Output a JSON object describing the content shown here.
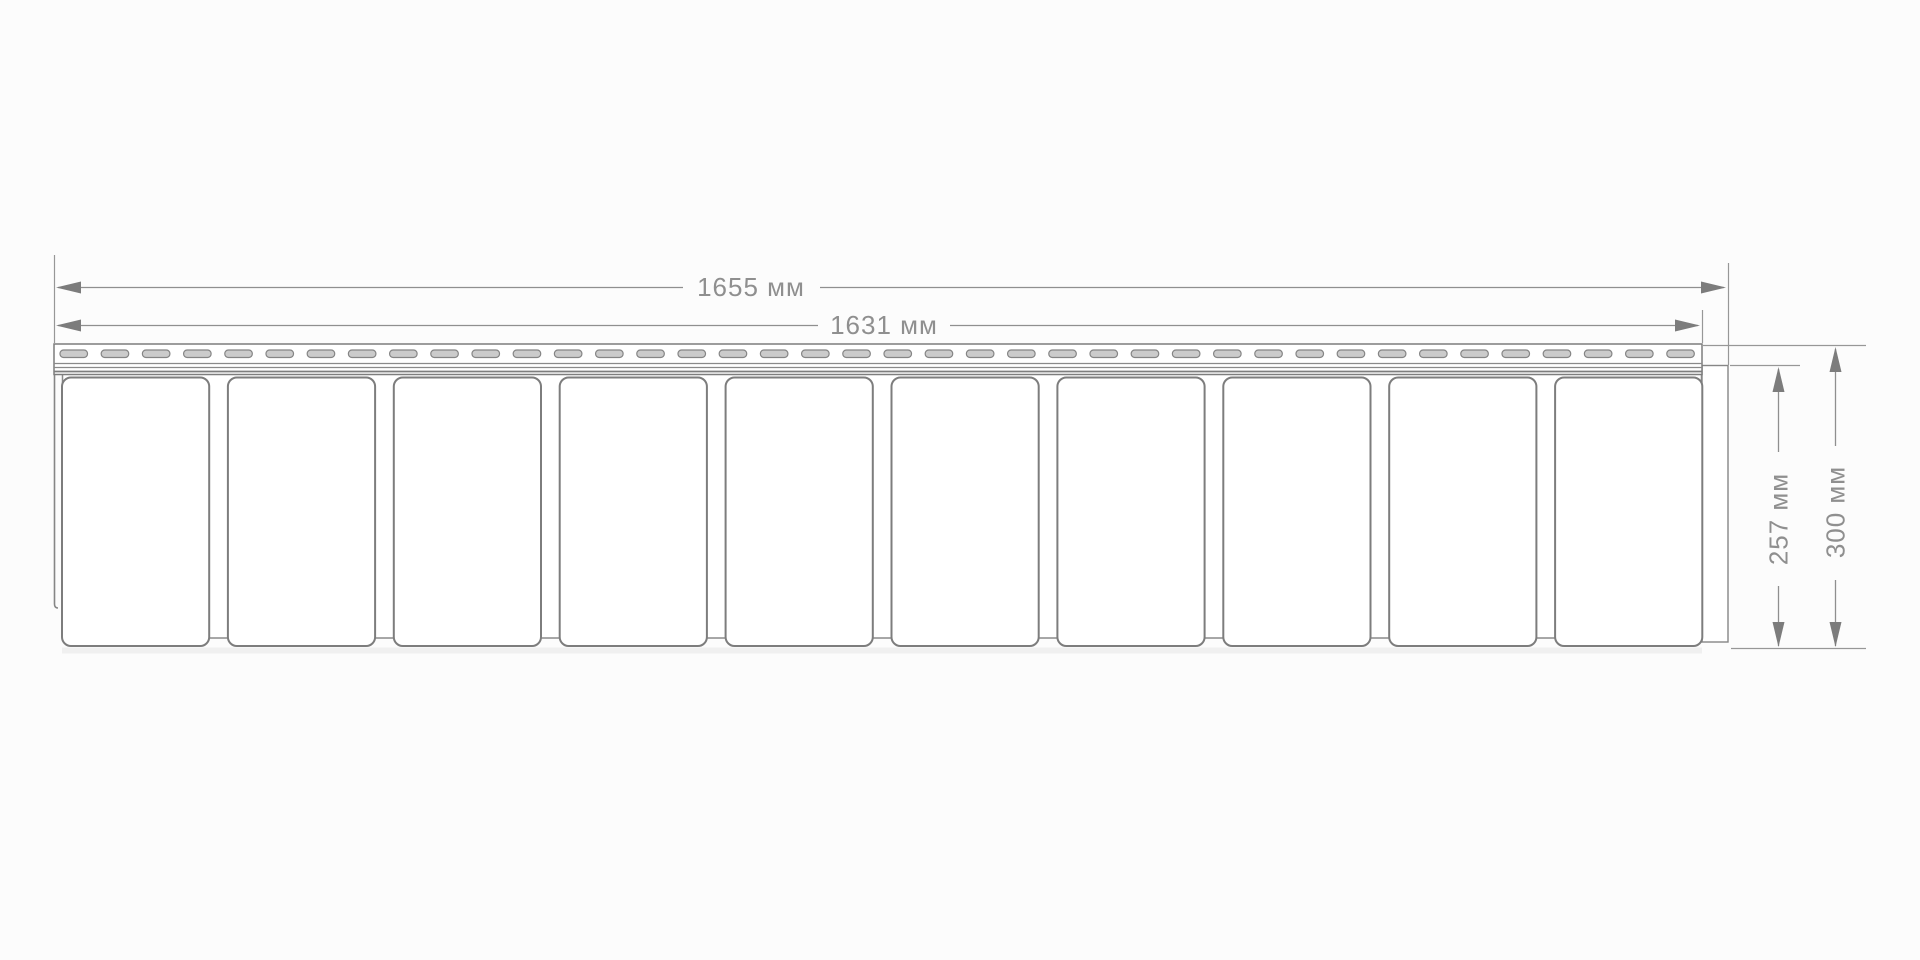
{
  "drawing": {
    "type": "technical-dimension-drawing",
    "subject": "siding-panel-front-view",
    "dims": {
      "total_length": "1655 мм",
      "nail_strip_length": "1631 мм",
      "panel_height": "257 мм",
      "total_height": "300 мм"
    },
    "panel": {
      "tile_count": 10,
      "perforation_count": 40
    },
    "colors": {
      "background": "#fcfcfc",
      "panel_fill": "#ffffff",
      "panel_line": "#7d7d7d",
      "dimension_line": "#8f8f8f",
      "dimension_text": "#8f8f8f",
      "perforation_fill": "#cbcbcb",
      "perforation_line": "#858585",
      "shadow": "#ececec"
    }
  }
}
